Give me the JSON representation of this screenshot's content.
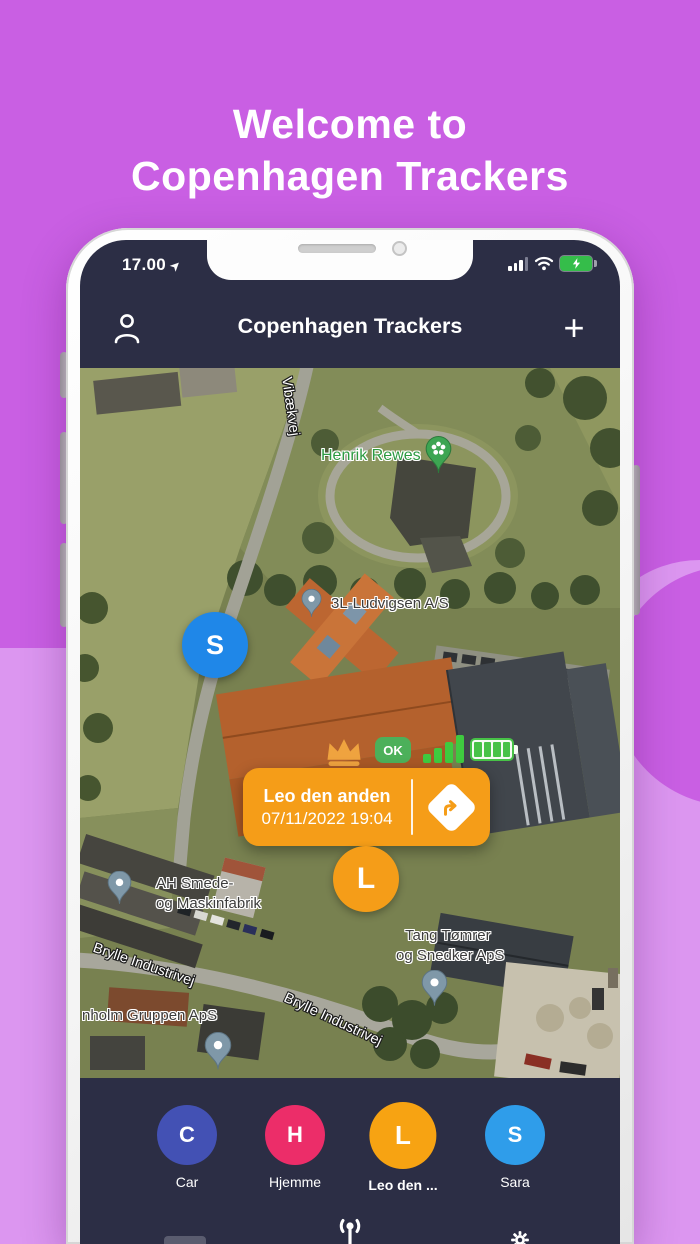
{
  "hero": {
    "line1": "Welcome to",
    "line2": "Copenhagen Trackers"
  },
  "status_bar": {
    "time": "17.00"
  },
  "header": {
    "title": "Copenhagen Trackers",
    "add_button": "+"
  },
  "map": {
    "road_labels": {
      "vibaekvej": "Vibækvej",
      "brylle": "Brylle Industrivej"
    },
    "pois": {
      "henrik": {
        "name": "Henrik Rewes"
      },
      "ludvigsen": {
        "name": "3L-Ludvigsen A/S"
      },
      "ah_smede": {
        "line1": "AH Smede-",
        "line2": "og Maskinfabrik"
      },
      "tang": {
        "line1": "Tang Tømrer",
        "line2": "og Snedker ApS"
      },
      "nholm": {
        "name": "nholm Gruppen ApS"
      }
    },
    "marker_s": {
      "letter": "S",
      "color": "#1f87e8"
    },
    "selected": {
      "name": "Leo den anden",
      "timestamp": "07/11/2022 19:04",
      "status_badge": "OK",
      "marker_letter": "L",
      "color": "#f59d18"
    }
  },
  "tracker_bar": {
    "items": [
      {
        "letter": "C",
        "label": "Car",
        "color": "#4351b4"
      },
      {
        "letter": "H",
        "label": "Hjemme",
        "color": "#ec2d69"
      },
      {
        "letter": "L",
        "label": "Leo den ...",
        "color": "#f7a312"
      },
      {
        "letter": "S",
        "label": "Sara",
        "color": "#2f9dea"
      }
    ]
  },
  "colors": {
    "background_top": "#c95fe3",
    "background_bottom": "#dc96f0",
    "screen_bg": "#2c2e45",
    "accent_orange": "#f59d18",
    "ok_green": "#4cb05a",
    "signal_green": "#3fca3f"
  }
}
